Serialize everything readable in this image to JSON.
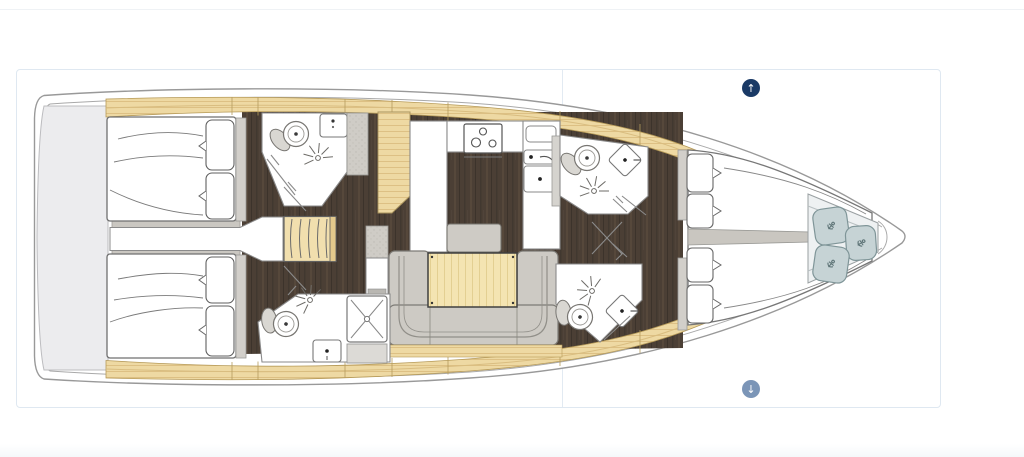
{
  "theme": {
    "panel-border": "#dfe8f1",
    "btn-up": "#1a3a66",
    "btn-down": "#7b95b7",
    "footer": "#f5f8fa",
    "toprule": "#eff2f5"
  },
  "controls": {
    "scroll_up_label": "↑",
    "scroll_down_label": "↓"
  },
  "deck_plan": {
    "type": "yacht-interior-deck-plan",
    "orientation": "bow-right",
    "features": [
      "swim-platform",
      "aft-cabin-port",
      "aft-cabin-starboard",
      "engine-corridor",
      "companionway-stairs",
      "head-aft-port",
      "head-aft-starboard",
      "galley",
      "salon-sofa",
      "salon-table",
      "head-fwd-port",
      "head-fwd-starboard",
      "owner-cabin-vberth",
      "sail-locker",
      "bow"
    ],
    "palette": {
      "hull_outline": "#999999",
      "deck_wood": "#eed9a3",
      "floor_wood": "#4b3f35",
      "furniture_gray": "#cdcac4",
      "fixture_outline": "#787672",
      "locker_cushion": "#c6d3d5",
      "platform_gray": "#ececee",
      "table_wood": "#f4e4b2"
    }
  }
}
